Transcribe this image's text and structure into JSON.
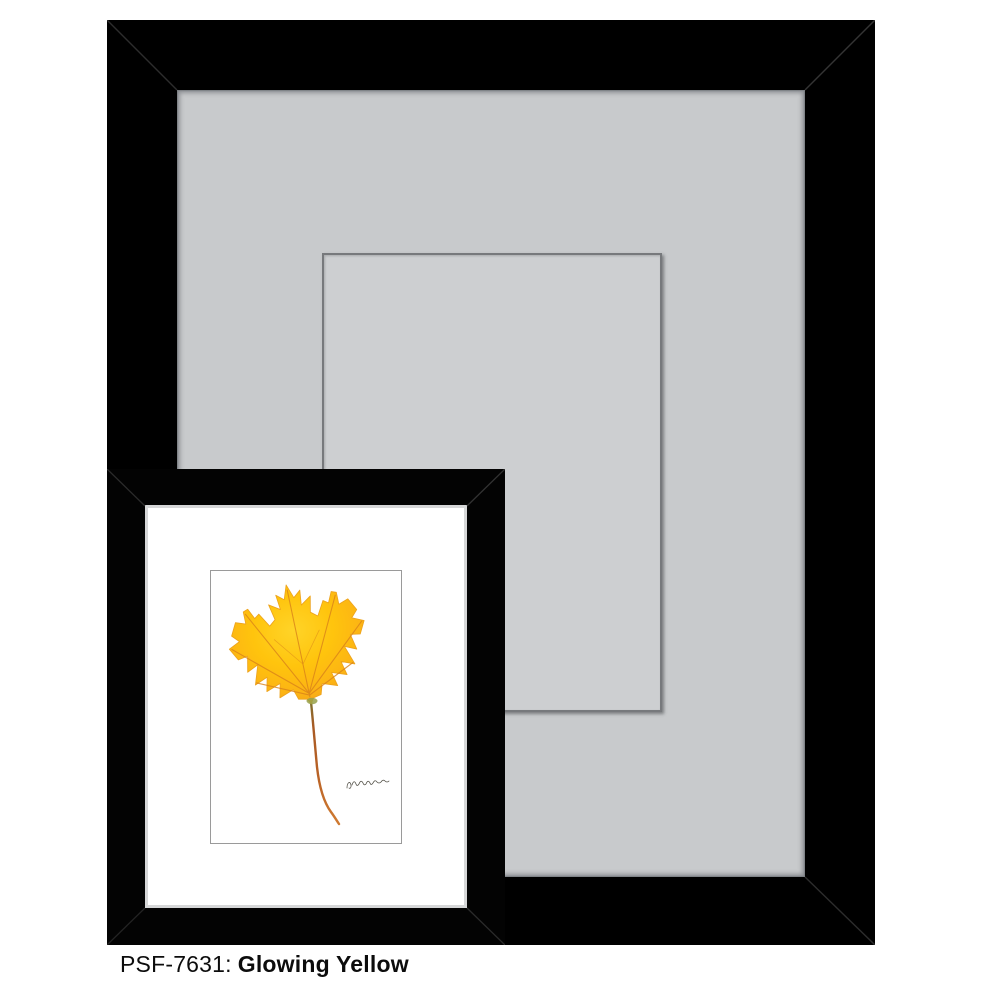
{
  "caption": {
    "sku": "PSF-7631:",
    "title": "Glowing Yellow"
  },
  "frames": {
    "large": {
      "frame_color": "#000000",
      "mat_color": "#c8cacc",
      "mat_shadow_color": "#9b9ea2",
      "opening_line_color": "#77797c",
      "opening_fill_color": "#cdcfd1"
    },
    "small": {
      "frame_color": "#030303",
      "lip_color": "#d6d7d8",
      "mat_color": "#ffffff",
      "art_border_color": "#9a9a9a"
    }
  },
  "artwork": {
    "subject": "yellow maple leaf with long curved stem",
    "background_color": "#ffffff",
    "leaf_color": "#ffc40d",
    "leaf_edge_color": "#f2a31c",
    "vein_color": "#d9821a",
    "stem_color": "#b5682a",
    "stem_base_green": "#96a04a",
    "signature_ink_color": "#55534a"
  }
}
